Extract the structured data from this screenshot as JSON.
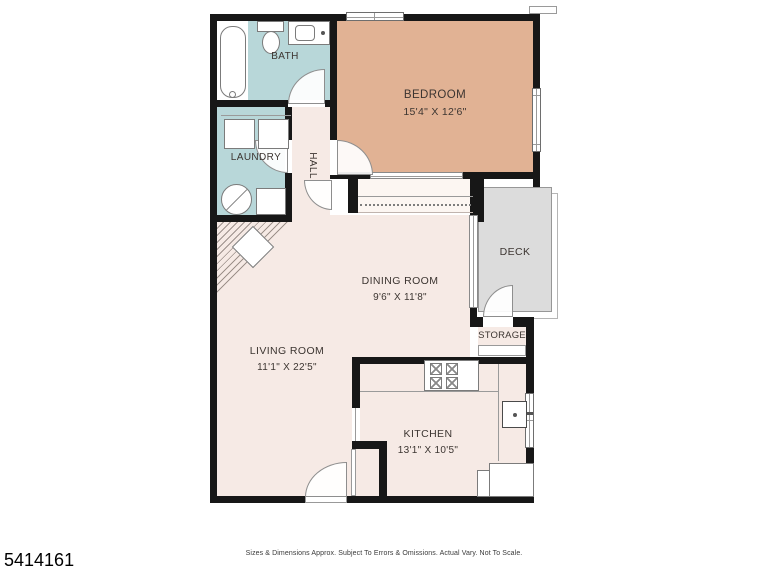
{
  "photo_id": "5414161",
  "footer": {
    "disclaimer": "Sizes & Dimensions Approx. Subject To Errors & Omissions. Actual Vary. Not To Scale."
  },
  "rooms": {
    "bath": {
      "label": "BATH"
    },
    "laundry": {
      "label": "LAUNDRY"
    },
    "hall": {
      "label": "HALL"
    },
    "bedroom": {
      "label": "BEDROOM",
      "dims": "15'4\" X 12'6\""
    },
    "deck": {
      "label": "DECK"
    },
    "dining": {
      "label": "DINING ROOM",
      "dims": "9'6\" X 11'8\""
    },
    "storage": {
      "label": "STORAGE"
    },
    "living": {
      "label": "LIVING ROOM",
      "dims": "11'1\" X 22'5\""
    },
    "kitchen": {
      "label": "KITCHEN",
      "dims": "13'1\" X 10'5\""
    }
  },
  "colors": {
    "wall": "#171717",
    "bath_teal": "#b8d7d9",
    "bedroom_tan": "#e1b294",
    "floor_pink": "#f6eae5",
    "closet_white": "#fcf6f2",
    "deck_gray": "#dcdcdc"
  }
}
